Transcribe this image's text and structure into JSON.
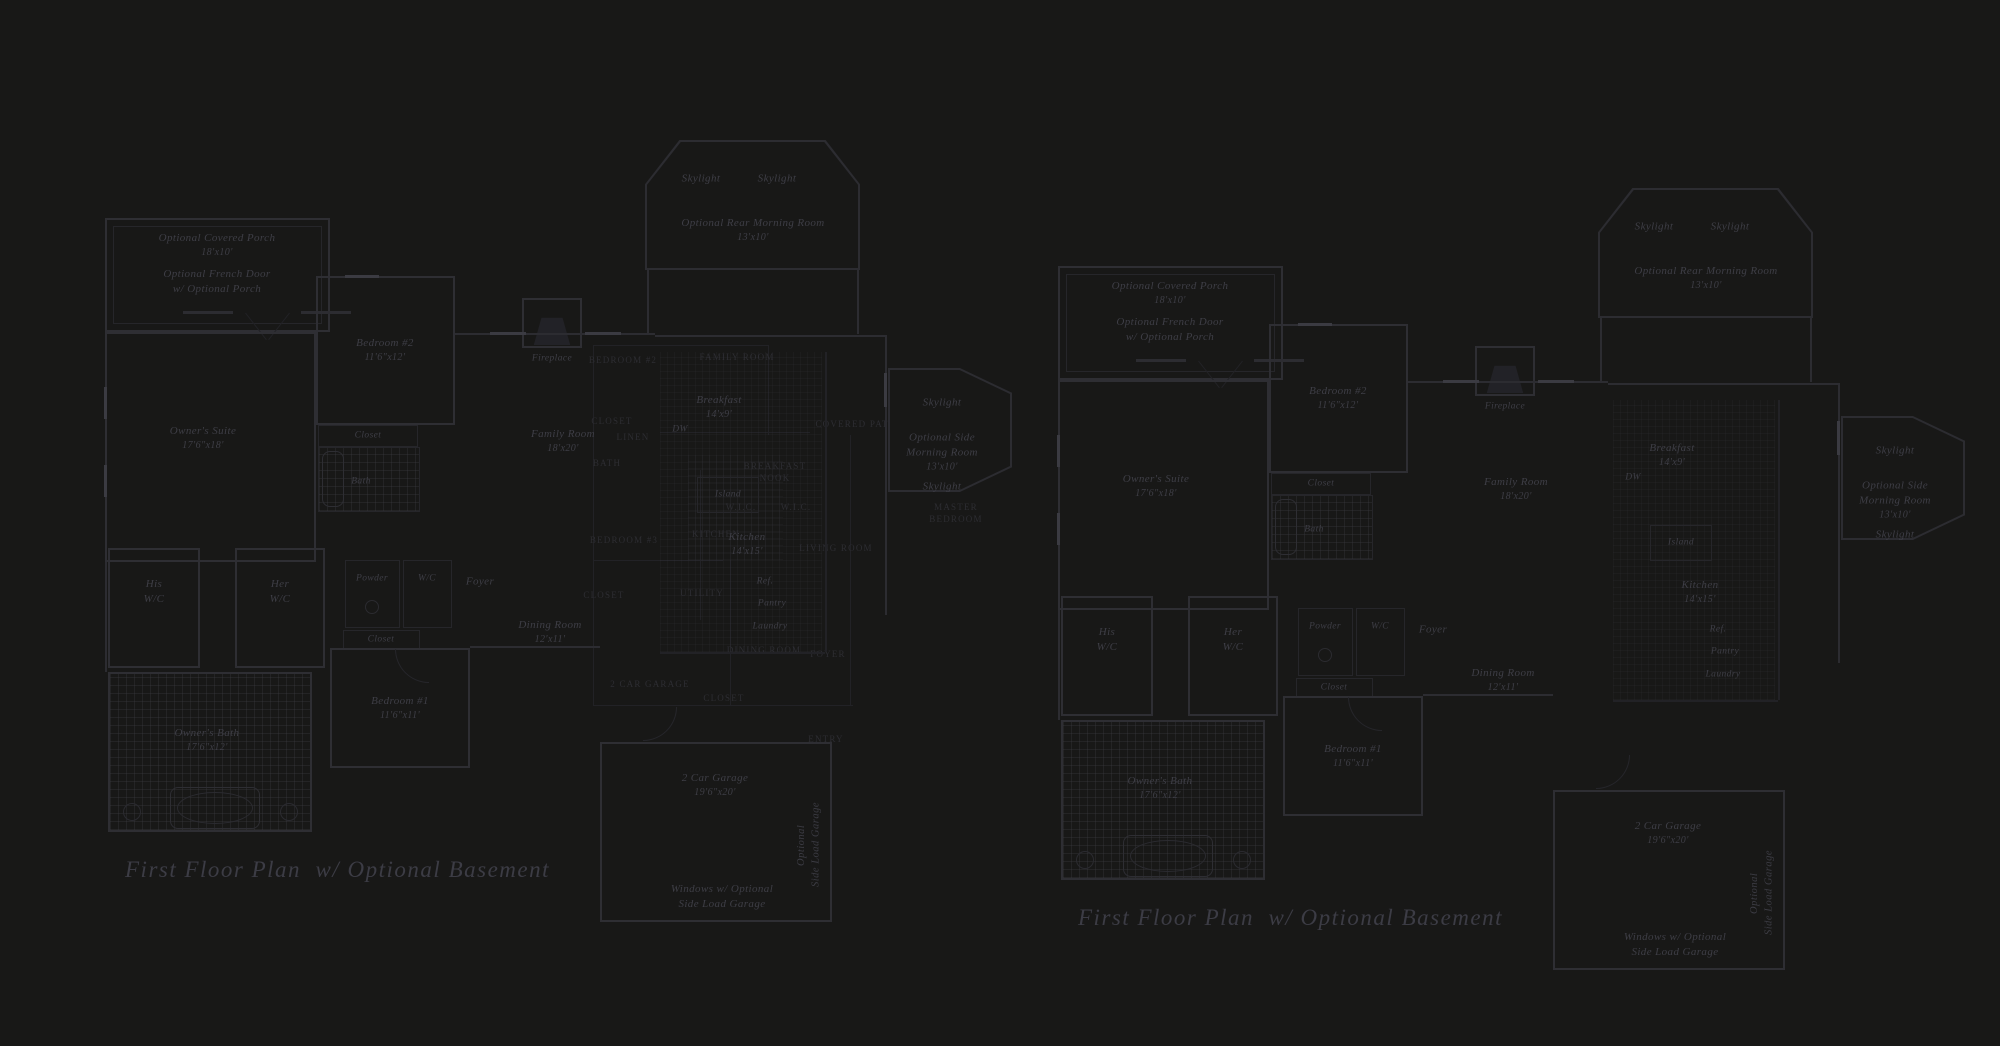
{
  "colors": {
    "background": "#181817",
    "wall_line": "#2c2c31",
    "faint_line": "#222226",
    "label_text": "#3e3e46",
    "underlay_text": "#2d2d32",
    "title_text": "#3c3c45"
  },
  "plan_title": "First Floor Plan  w/ Optional Basement",
  "plan": {
    "covered_porch": {
      "name": "Optional Covered Porch",
      "dims": "18'x10'"
    },
    "french_door_note": {
      "line1": "Optional French Door",
      "line2": "w/ Optional Porch"
    },
    "owners_suite": {
      "name": "Owner's Suite",
      "dims": "17'6\"x18'"
    },
    "bedroom2": {
      "name": "Bedroom #2",
      "dims": "11'6\"x12'"
    },
    "closet": "Closet",
    "bath": "Bath",
    "fireplace": "Fireplace",
    "family_room": {
      "name": "Family Room",
      "dims": "18'x20'"
    },
    "skylight": "Skylight",
    "rear_morning_room": {
      "name": "Optional Rear Morning Room",
      "dims": "13'x10'"
    },
    "side_morning_room": {
      "line1": "Optional Side",
      "line2": "Morning Room",
      "dims": "13'x10'"
    },
    "breakfast": {
      "name": "Breakfast",
      "dims": "14'x9'"
    },
    "dw": "DW",
    "island": "Island",
    "kitchen": {
      "name": "Kitchen",
      "dims": "14'x15'"
    },
    "ref": "Ref.",
    "pantry": "Pantry",
    "laundry": "Laundry",
    "his_wc": {
      "line1": "His",
      "line2": "W/C"
    },
    "her_wc": {
      "line1": "Her",
      "line2": "W/C"
    },
    "powder": "Powder",
    "wc": "W/C",
    "closet2": "Closet",
    "foyer": "Foyer",
    "dining_room": {
      "name": "Dining Room",
      "dims": "12'x11'"
    },
    "bedroom1": {
      "name": "Bedroom #1",
      "dims": "11'6\"x11'"
    },
    "owners_bath": {
      "name": "Owner's Bath",
      "dims": "17'6\"x12'"
    },
    "garage": {
      "name": "2 Car Garage",
      "dims": "19'6\"x20'"
    },
    "garage_note": {
      "line1": "Windows w/ Optional",
      "line2": "Side Load Garage"
    },
    "side_load_garage": {
      "line1": "Optional",
      "line2": "Side Load Garage"
    }
  },
  "underlay": {
    "labels": [
      "BEDROOM #2",
      "FAMILY ROOM",
      "CLOSET",
      "LINEN",
      "BATH",
      "BREAKFAST",
      "NOOK",
      "COVERED PATIO",
      "KITCHEN",
      "BEDROOM #3",
      "LIVING ROOM",
      "MASTER",
      "BEDROOM",
      "W.I.C.",
      "W.I.C.",
      "CLOSET",
      "UTILITY",
      "DINING ROOM",
      "FOYER",
      "2 CAR GARAGE",
      "CLOSET",
      "ENTRY"
    ]
  }
}
